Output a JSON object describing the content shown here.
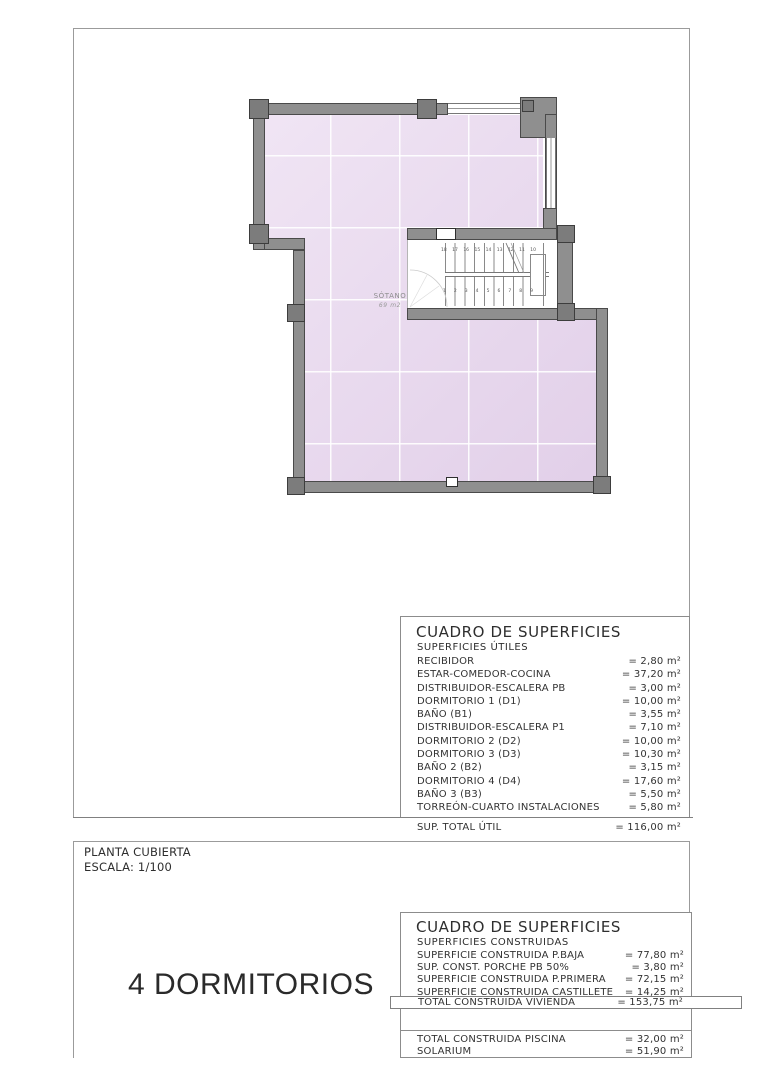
{
  "document": {
    "plan": {
      "room_label": "SÓTANO",
      "room_area": "69 m2",
      "stair_numbers_top": "18 17 16 15 14 13 12 11 10",
      "stair_numbers_bottom": "1 2 3 4 5 6 7 8 9"
    },
    "surface_table_utiles": {
      "title": "CUADRO DE SUPERFICIES",
      "subtitle": "SUPERFICIES ÚTILES",
      "rows": [
        {
          "label": "RECIBIDOR",
          "value": "= 2,80 m²"
        },
        {
          "label": "ESTAR-COMEDOR-COCINA",
          "value": "= 37,20 m²"
        },
        {
          "label": "DISTRIBUIDOR-ESCALERA PB",
          "value": "= 3,00 m²"
        },
        {
          "label": "DORMITORIO 1 (D1)",
          "value": "= 10,00 m²"
        },
        {
          "label": "BAÑO  (B1)",
          "value": "= 3,55 m²"
        },
        {
          "label": "DISTRIBUIDOR-ESCALERA P1",
          "value": "= 7,10 m²"
        },
        {
          "label": "DORMITORIO 2 (D2)",
          "value": "= 10,00 m²"
        },
        {
          "label": "DORMITORIO 3 (D3)",
          "value": "= 10,30 m²"
        },
        {
          "label": "BAÑO 2 (B2)",
          "value": "= 3,15 m²"
        },
        {
          "label": "DORMITORIO 4 (D4)",
          "value": "= 17,60 m²"
        },
        {
          "label": "BAÑO 3 (B3)",
          "value": "= 5,50 m²"
        },
        {
          "label": "TORREÓN-CUARTO INSTALACIONES",
          "value": "= 5,80 m²"
        }
      ],
      "total_label": "SUP. TOTAL ÚTIL",
      "total_value": "= 116,00 m²"
    },
    "surface_table_construidas": {
      "title": "CUADRO DE SUPERFICIES",
      "subtitle": "SUPERFICIES CONSTRUIDAS",
      "rows": [
        {
          "label": "SUPERFICIE  CONSTRUIDA P.BAJA",
          "value": "= 77,80 m²"
        },
        {
          "label": "SUP. CONST. PORCHE PB 50%",
          "value": "= 3,80 m²"
        },
        {
          "label": "SUPERFICIE CONSTRUIDA P.PRIMERA",
          "value": "= 72,15 m²"
        },
        {
          "label": "SUPERFICIE CONSTRUIDA CASTILLETE",
          "value": "= 14,25 m²"
        }
      ],
      "total_label": "TOTAL CONSTRUIDA VIVIENDA",
      "total_value": "= 153,75 m²",
      "extra_rows": [
        {
          "label": "TOTAL CONSTRUIDA PISCINA",
          "value": "= 32,00 m²"
        },
        {
          "label": "SOLARIUM",
          "value": "= 51,90 m²"
        }
      ]
    },
    "titleblock": {
      "plan_name": "PLANTA CUBIERTA",
      "scale": "ESCALA: 1/100",
      "type_label": "4 DORMITORIOS"
    },
    "colors": {
      "floor_fill": "#e9d8ef",
      "wall_fill": "#8f8f8f",
      "wall_outline": "#4a4a4a",
      "line": "#8c8c8c"
    }
  }
}
